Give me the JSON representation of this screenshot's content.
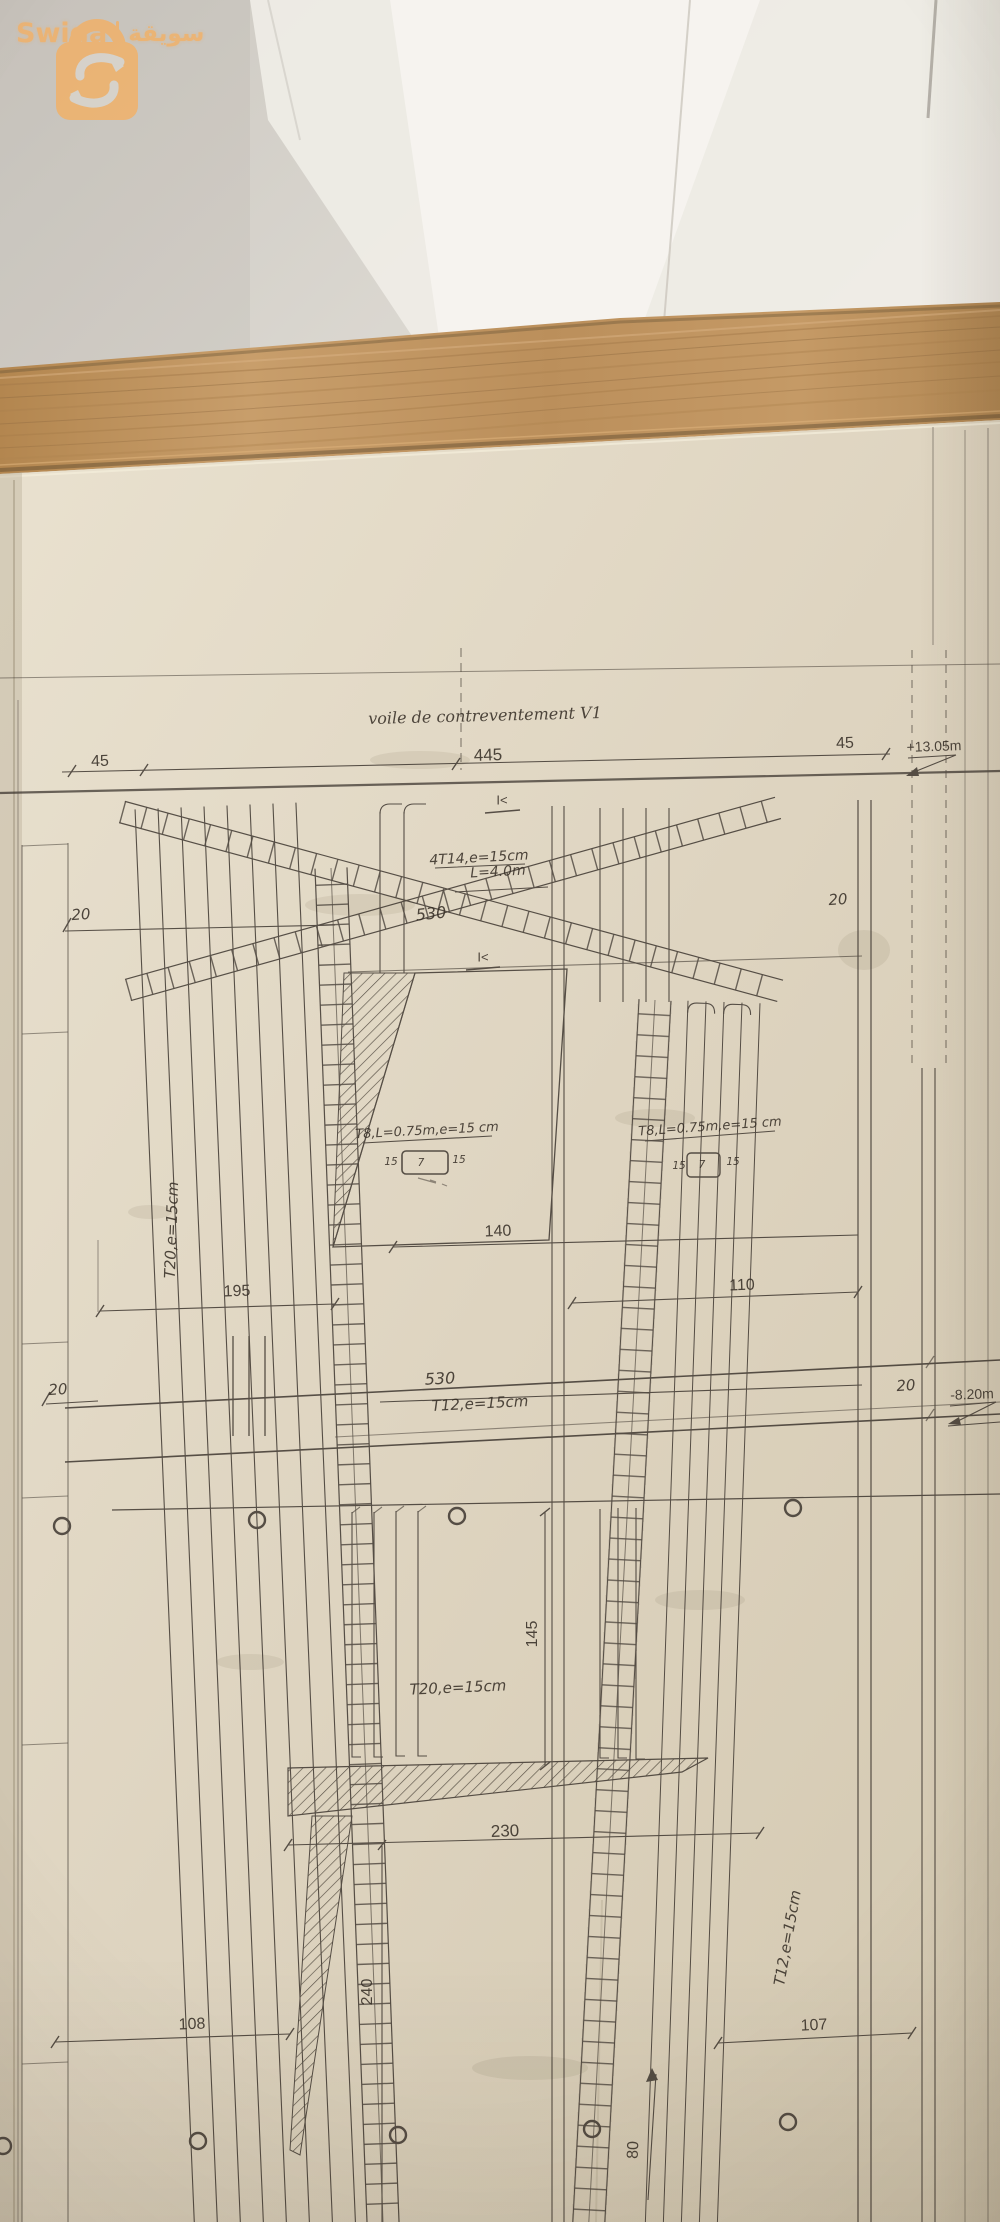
{
  "watermark": {
    "brand_latin": "Swiga",
    "brand_arabic": "سويقة",
    "accent_color": "#f2b066",
    "icon": "shopping-bag-s-arrow-icon"
  },
  "blueprint": {
    "title": "voile de contreventement V1",
    "top_dims": {
      "left": "45",
      "center": "445",
      "right": "45"
    },
    "levels": {
      "upper": "+13.05m",
      "lower": "-8.20m"
    },
    "section_marks": {
      "upper": "I<",
      "lower": "I<"
    },
    "diagonal_bracing": {
      "callout": "4T14,e=15cm",
      "length": "L=4.0m",
      "span": "530"
    },
    "thickness": {
      "upper_left": "20",
      "upper_right": "20",
      "mid_left": "20",
      "mid_right": "20"
    },
    "tie_left": {
      "callout": "T8,L=0.75m,e=15 cm",
      "w": "15",
      "h": "7",
      "w2": "15"
    },
    "tie_right": {
      "callout": "T8,L=0.75m,e=15 cm",
      "w": "15",
      "h": "7",
      "w2": "15"
    },
    "wall_rebar": {
      "vertical_left": "T20,e=15cm",
      "vertical_bottom": "T20,e=15cm",
      "horizontal_mid": "T12,e=15cm",
      "horizontal_mid_span": "530",
      "vertical_right": "T12,e=15cm"
    },
    "dims": {
      "d140": "140",
      "d195": "195",
      "d110": "110",
      "d145": "145",
      "d230": "230",
      "d240": "240",
      "d108": "108",
      "d107": "107",
      "d80": "80"
    }
  }
}
